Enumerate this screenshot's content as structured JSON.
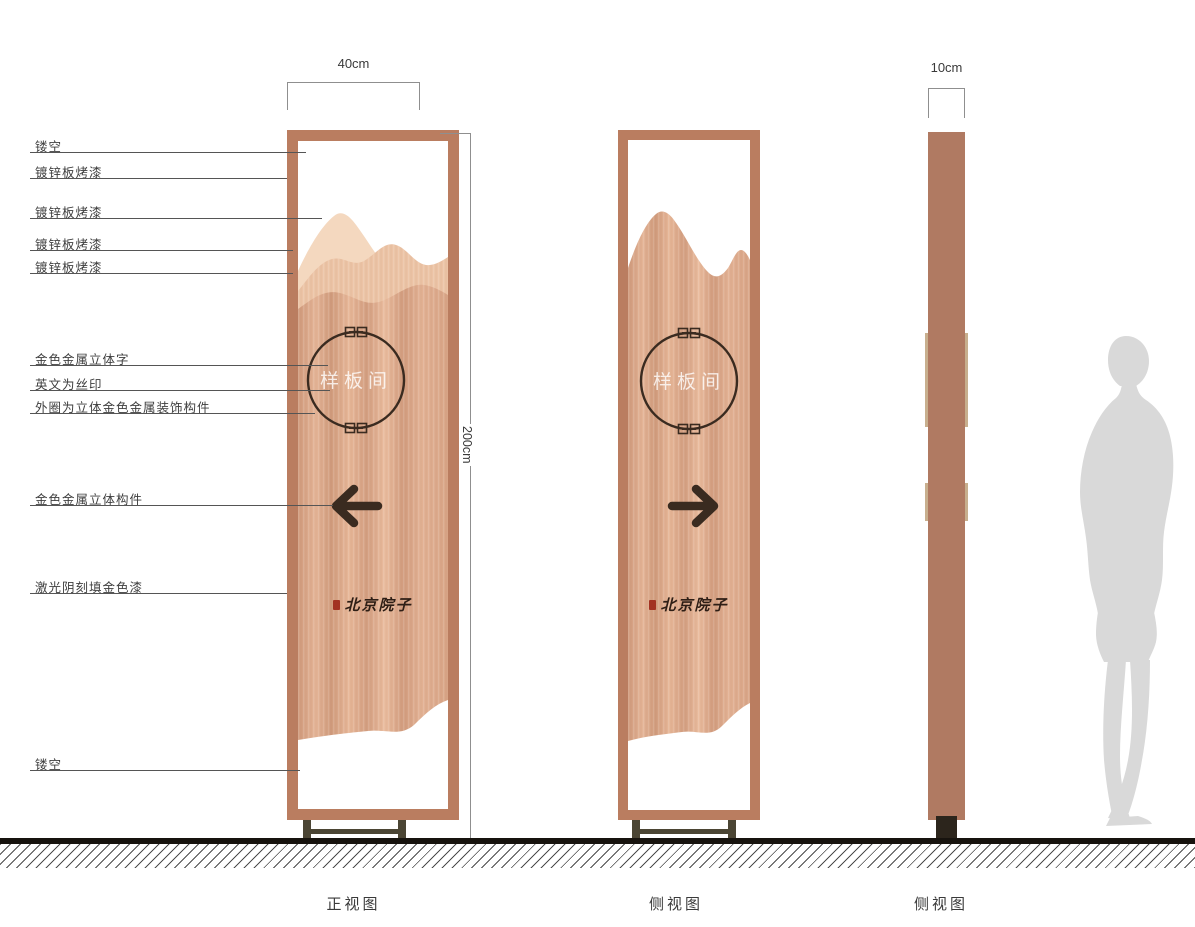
{
  "dimensions": {
    "width_label": "40cm",
    "height_label": "200cm",
    "depth_label": "10cm"
  },
  "views": {
    "front": "正视图",
    "back": "侧视图",
    "side": "侧视图"
  },
  "annotations": {
    "hollow_top": "镂空",
    "galvanized_paint_1": "镀锌板烤漆",
    "galvanized_paint_2": "镀锌板烤漆",
    "galvanized_paint_3": "镀锌板烤漆",
    "galvanized_paint_4": "镀锌板烤漆",
    "gold_metal_3d_text": "金色金属立体字",
    "english_silkscreen": "英文为丝印",
    "outer_ring_gold_deco": "外圈为立体金色金属装饰构件",
    "gold_metal_3d_component": "金色金属立体构件",
    "laser_engraved_gold": "激光阴刻填金色漆",
    "hollow_bottom": "镂空"
  },
  "sign": {
    "room_label": "样板间",
    "brand_name": "北京院子"
  },
  "colors": {
    "frame_copper": "#ba7d60",
    "panel_copper_mid": "#dca88a",
    "panel_copper_light": "#f2d4ba",
    "side_panel": "#b07a62",
    "edge_trim": "#c8af8e",
    "ink_dark": "#3a2b20",
    "seal_red": "#a33222",
    "silhouette_gray": "#d9d9d9"
  }
}
